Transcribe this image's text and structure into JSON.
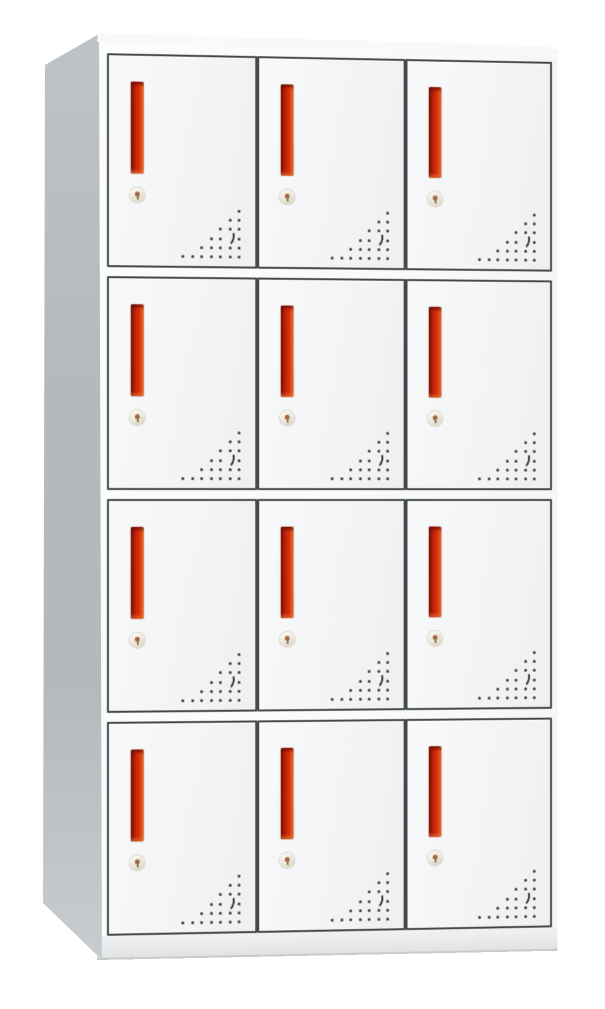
{
  "meta": {
    "description": "Product photo of a white steel office locker cabinet with twelve compartment doors, red recessed pull handles, round cam locks and triangular ventilation hole patterns, shown in slight left-side perspective on a white background",
    "image_type": "product-photo",
    "background_color": "#ffffff"
  },
  "cabinet": {
    "kind": "12-door steel locker cabinet",
    "rows": 4,
    "columns": 3,
    "door_count": 12,
    "colors": {
      "body_white": "#f2f4f5",
      "door_border": "#45484a",
      "frame": "#f9fafb",
      "side_panel": "#b3b9bd",
      "handle_red": "#d5300e",
      "handle_dark_red": "#7c150a",
      "handle_orange_edge": "#ee7c35",
      "vent_dot": "#3a3c3d",
      "base_strip": "#e8eaeb"
    },
    "door": {
      "handle": {
        "label": "vertical recessed pull handle",
        "color": "#d5300e"
      },
      "lock": {
        "label": "round cam lock with keyhole"
      },
      "vents": {
        "label": "ventilation holes",
        "pattern": "right-aligned triangular dot grid with small crescent cutout",
        "row_counts": [
          1,
          2,
          3,
          4,
          5,
          7
        ],
        "crescent_skip_row": 3,
        "crescent_skip_col": 1,
        "dot_color": "#3a3c3d"
      }
    }
  }
}
